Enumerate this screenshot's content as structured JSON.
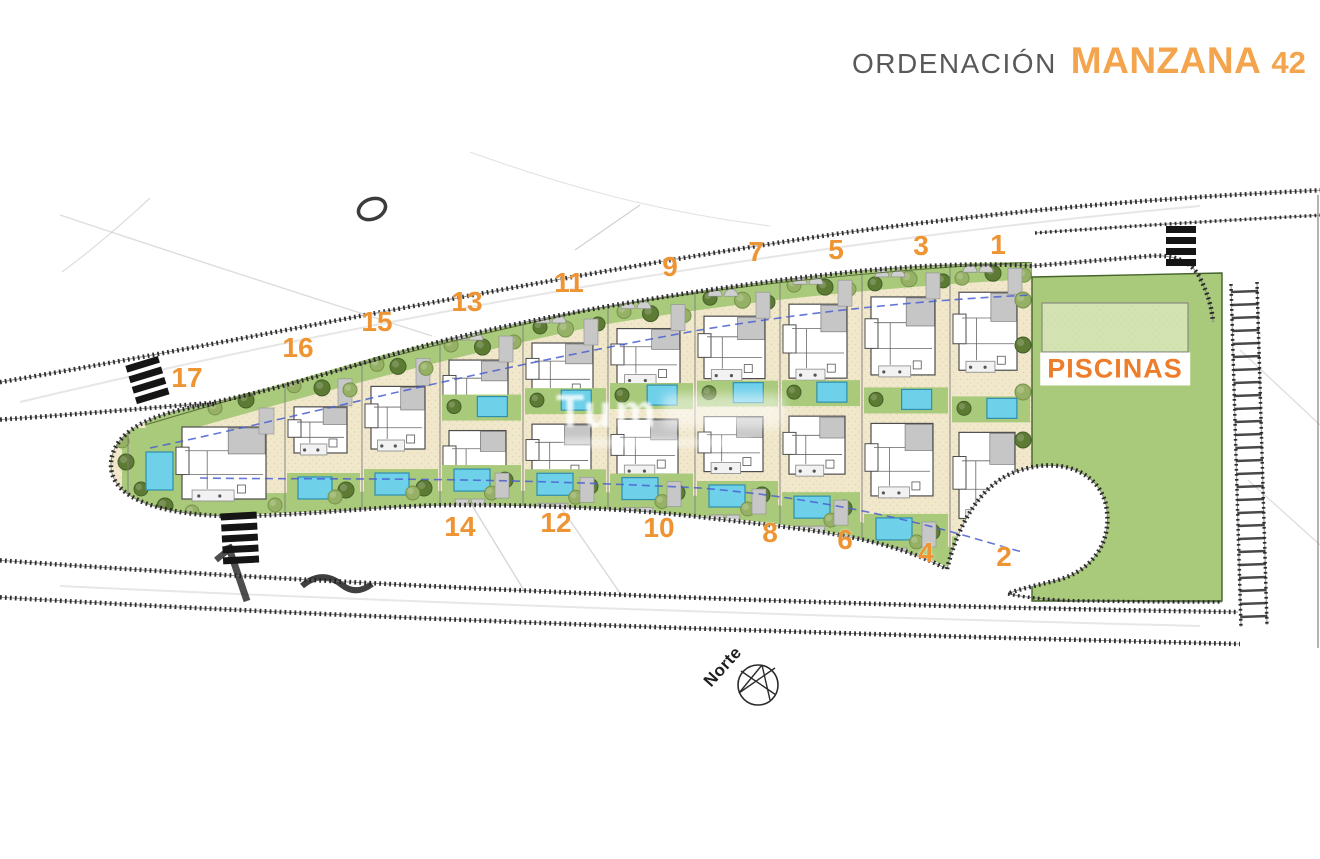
{
  "title": {
    "prefix": "ORDENACIÓN",
    "highlight": "MANZANA",
    "number": "42"
  },
  "plan": {
    "pool_area_label": "PISCINAS",
    "north_label": "Norte",
    "watermark_text": "Tum",
    "plots": [
      {
        "label": "1"
      },
      {
        "label": "2"
      },
      {
        "label": "3"
      },
      {
        "label": "4"
      },
      {
        "label": "5"
      },
      {
        "label": "6"
      },
      {
        "label": "7"
      },
      {
        "label": "8"
      },
      {
        "label": "9"
      },
      {
        "label": "10"
      },
      {
        "label": "11"
      },
      {
        "label": "12"
      },
      {
        "label": "13"
      },
      {
        "label": "14"
      },
      {
        "label": "15"
      },
      {
        "label": "16"
      },
      {
        "label": "17"
      }
    ]
  },
  "colors": {
    "accent_orange": "#ef9433",
    "title_gray": "#58595b",
    "lawn_green": "#a9ca7b",
    "parcel_sand": "#f1e8cc",
    "pool_blue": "#6fd0ea",
    "road_ink": "#1f1f1f"
  }
}
